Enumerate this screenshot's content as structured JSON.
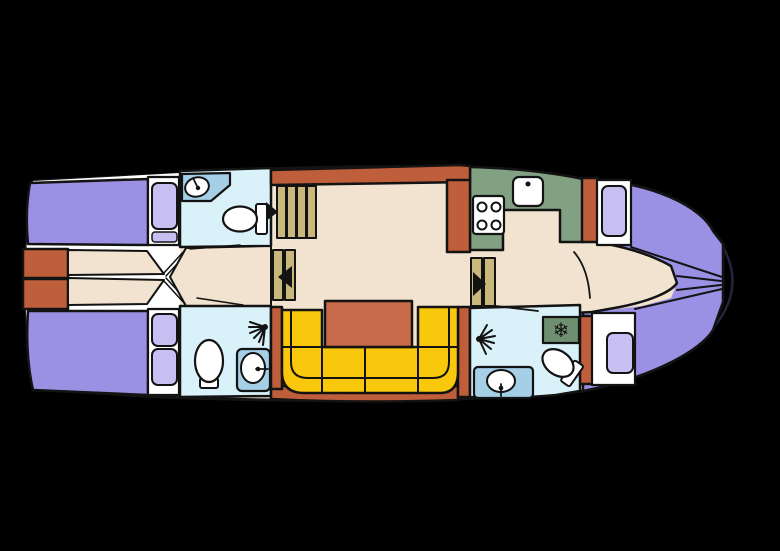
{
  "colors": {
    "background": "#000000",
    "outline": "#131313",
    "bow_shadow": "#23233a",
    "hull_floor": "#f1e3d0",
    "cabin_white": "#ffffff",
    "berth_purple": "#9b91e4",
    "pillow_purple": "#c7bff2",
    "deck_terracotta": "#bf5e3a",
    "table_terracotta": "#c86b4b",
    "sofa_yellow": "#f9c70b",
    "galley_green": "#82a183",
    "freezer_green": "#6e9070",
    "bath_blue": "#d9f1f8",
    "counter_blue": "#a5cee7",
    "stair_khaki": "#c9b87b",
    "fixture_black": "#131313"
  },
  "icons": {
    "snowflake_char": "❄",
    "names": [
      "sink-icon",
      "toilet-icon",
      "shower-icon",
      "stove-icon",
      "stairs-icon",
      "arrow-icon",
      "snowflake-icon",
      "bed-icon",
      "pillow-icon",
      "sofa-icon",
      "table-icon"
    ]
  }
}
